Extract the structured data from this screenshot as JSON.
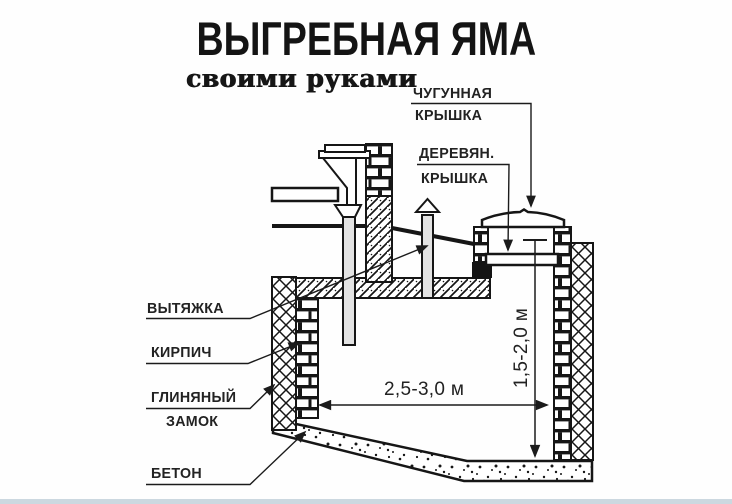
{
  "title": "ВЫГРЕБНАЯ ЯМА",
  "subtitle": "своими руками",
  "labels": {
    "cast_iron_cover_line1": "ЧУГУННАЯ",
    "cast_iron_cover_line2": "КРЫШКА",
    "wooden_cover_line1": "ДЕРЕВЯН.",
    "wooden_cover_line2": "КРЫШКА",
    "vent": "ВЫТЯЖКА",
    "brick": "КИРПИЧ",
    "clay_lock_line1": "ГЛИНЯНЫЙ",
    "clay_lock_line2": "ЗАМОК",
    "concrete": "БЕТОН"
  },
  "dimensions": {
    "pit_width": "2,5-3,0 м",
    "pit_depth": "1,5-2,0 м"
  },
  "colors": {
    "ink": "#1b1b1b",
    "paper": "#fefefe",
    "pipe_fill": "#e3e3e3",
    "bottom_border": "#ccd8e0"
  }
}
